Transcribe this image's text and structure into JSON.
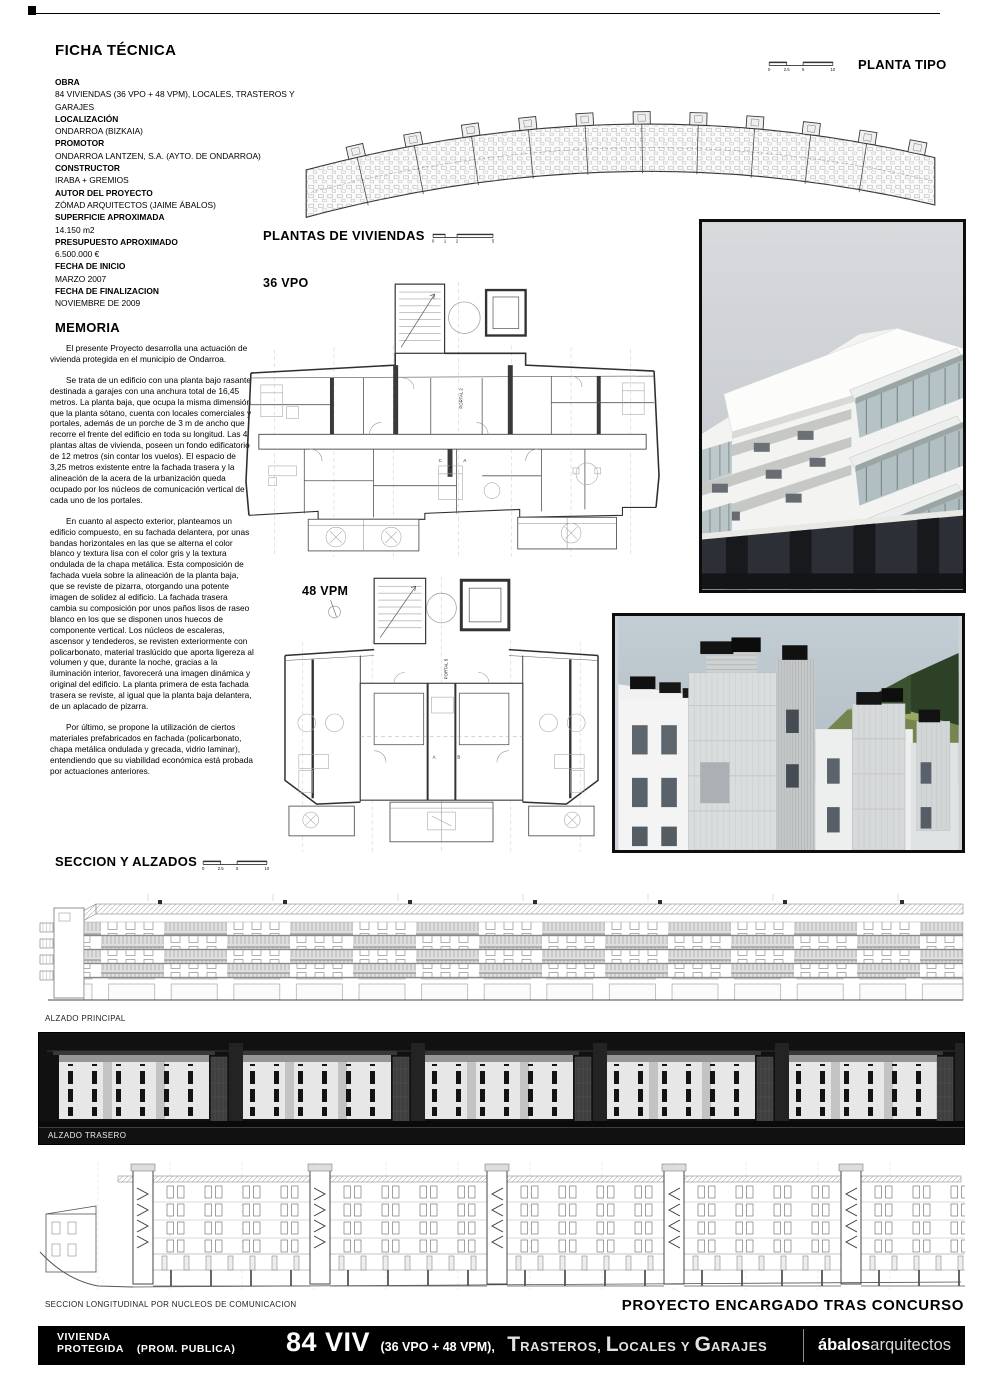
{
  "colors": {
    "page_bg": "#ffffff",
    "bar_bg": "#000000",
    "drawing_line": "#555555",
    "photo_frame": "#0d0d0d"
  },
  "ficha": {
    "heading": "FICHA TÉCNICA",
    "fields": [
      {
        "label": "OBRA",
        "value": "84 VIVIENDAS (36 VPO + 48 VPM), LOCALES, TRASTEROS Y GARAJES"
      },
      {
        "label": "LOCALIZACIÓN",
        "value": "ONDARROA (BIZKAIA)"
      },
      {
        "label": "PROMOTOR",
        "value": "ONDARROA LANTZEN, S.A. (AYTO. DE ONDARROA)"
      },
      {
        "label": "CONSTRUCTOR",
        "value": "IRABA + GREMIOS"
      },
      {
        "label": "AUTOR DEL PROYECTO",
        "value": "ZÓMAD ARQUITECTOS (JAIME ÁBALOS)"
      },
      {
        "label": "SUPERFICIE APROXIMADA",
        "value": "14.150 m2"
      },
      {
        "label": "PRESUPUESTO APROXIMADO",
        "value": "6.500.000 €"
      },
      {
        "label": "FECHA DE INICIO",
        "value": "MARZO 2007"
      },
      {
        "label": "FECHA DE FINALIZACION",
        "value": "NOVIEMBRE DE 2009"
      }
    ]
  },
  "memoria": {
    "heading": "MEMORIA",
    "paragraphs": [
      "El presente Proyecto desarrolla una actuación de vivienda protegida en el municipio de Ondarroa.",
      "Se trata de un edificio con una planta bajo rasante destinada a garajes con una anchura total de 16,45 metros. La planta baja, que ocupa la misma dimensión que la planta sótano, cuenta con locales comerciales y portales, además de un porche de 3 m de ancho que recorre el frente del edificio en toda su longitud. Las 4 plantas altas de vivienda, poseen un fondo edificatorio de 12 metros (sin contar los vuelos). El espacio de 3,25 metros existente entre la fachada trasera y la alineación de la acera de la urbanización queda ocupado por los núcleos de comunicación vertical de cada uno de los portales.",
      "En cuanto al aspecto exterior, planteamos un edificio compuesto, en su fachada delantera, por unas bandas horizontales en las que se alterna el color blanco y textura lisa con el color gris y la textura ondulada de la chapa metálica. Esta composición de fachada vuela sobre la alineación de la planta baja, que se reviste de pizarra, otorgando una potente imagen de solidez al edificio. La fachada trasera cambia su composición por unos paños lisos de raseo blanco en los que se disponen unos huecos de componente vertical. Los núcleos de escaleras, ascensor y tendederos, se revisten exteriormente con policarbonato, material traslúcido que aporta ligereza al volumen y que, durante la noche, gracias a la iluminación interior, favorecerá una imagen dinámica y original del edificio. La planta primera de esta fachada trasera se reviste, al igual que la planta baja delantera, de un aplacado de pizarra.",
      "Por último, se propone la utilización de ciertos materiales prefabricados en fachada (policarbonato, chapa metálica ondulada y grecada, vidrio laminar), entendiendo que su viabilidad económica está probada por actuaciones anteriores."
    ]
  },
  "planta_tipo": {
    "heading": "PLANTA TIPO",
    "scale": [
      "0",
      "2.5",
      "5",
      "10"
    ]
  },
  "plantas_viviendas": {
    "heading": "PLANTAS DE VIVIENDAS",
    "scale": [
      "0",
      "1",
      "2",
      "5"
    ],
    "plans": [
      {
        "label": "36 VPO",
        "portal": "PORTAL 2",
        "marks": [
          "C",
          "B",
          "A"
        ]
      },
      {
        "label": "48 VPM",
        "portal": "PORTAL 5",
        "marks": [
          "A",
          "B"
        ]
      }
    ]
  },
  "seccion_alzados": {
    "heading": "SECCION Y ALZADOS",
    "scale": [
      "0",
      "2.5",
      "5",
      "10"
    ],
    "labels": {
      "principal": "ALZADO PRINCIPAL",
      "trasero": "ALZADO TRASERO",
      "longitudinal": "SECCION LONGITUDINAL POR NUCLEOS DE COMUNICACION"
    }
  },
  "footer": {
    "award_note": "PROYECTO ENCARGADO TRAS CONCURSO",
    "left1": "VIVIENDA",
    "left2": "PROTEGIDA",
    "left3": "(PROM. PUBLICA)",
    "big": "84 VIV",
    "mid": "(36 VPO + 48 VPM),",
    "caps": {
      "t": "T",
      "t_rest": "RASTEROS,",
      "l": "L",
      "l_rest": "OCALES",
      "y": "Y",
      "g": "G",
      "g_rest": "ARAJES"
    },
    "firm_bold": "ábalos",
    "firm_regular": "arquitectos"
  }
}
